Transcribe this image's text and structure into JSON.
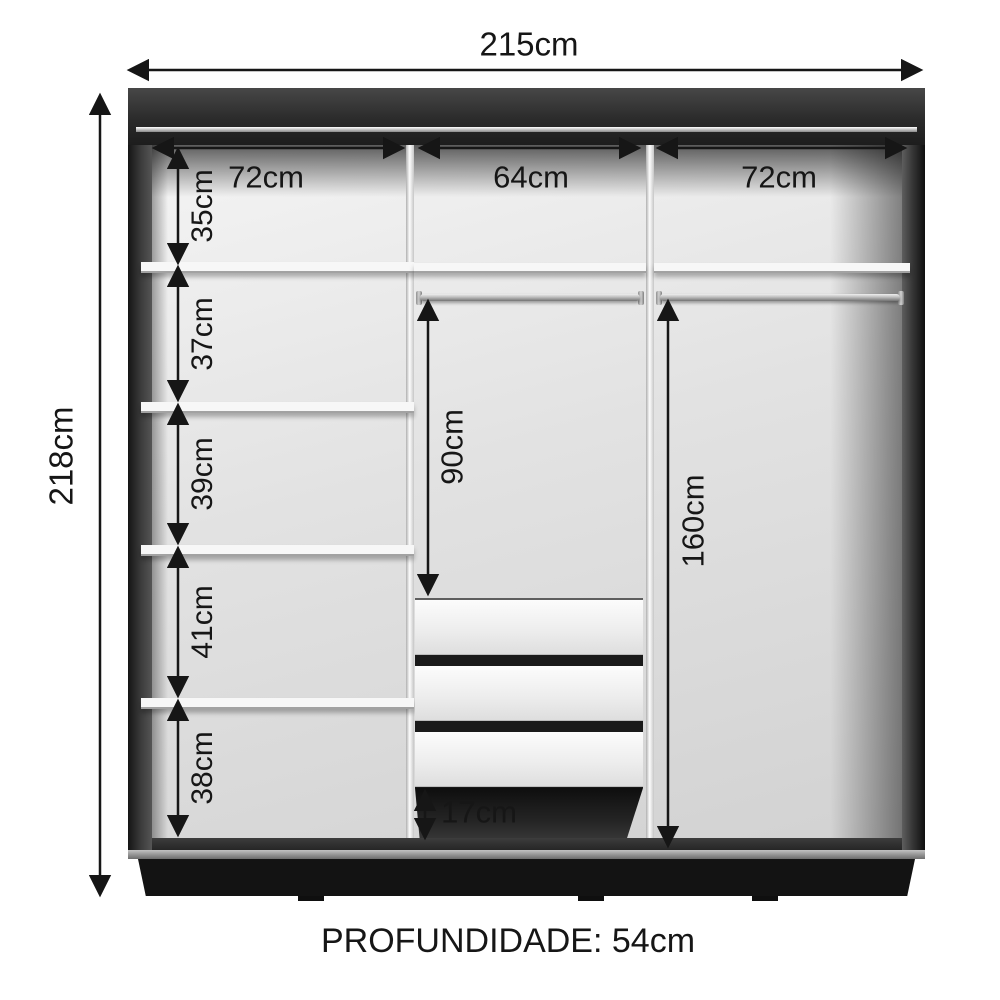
{
  "wardrobe": {
    "overall": {
      "width": "215cm",
      "height": "218cm",
      "depth": "PROFUNDIDADE: 54cm"
    },
    "top_sections": {
      "left_width": "72cm",
      "middle_width": "64cm",
      "right_width": "72cm"
    },
    "left_shelf_gaps": [
      {
        "label": "35cm"
      },
      {
        "label": "37cm"
      },
      {
        "label": "39cm"
      },
      {
        "label": "41cm"
      },
      {
        "label": "38cm"
      }
    ],
    "middle_column": {
      "rod_to_drawers": "90cm",
      "below_drawers_gap": "17cm",
      "drawer_count": 3
    },
    "right_column": {
      "rod_to_base": "160cm"
    },
    "colors": {
      "frame_dark": "#2b2b2b",
      "interior_light": "#e9e9e9",
      "dimension_ink": "#161616",
      "plinth": "#131313"
    }
  }
}
